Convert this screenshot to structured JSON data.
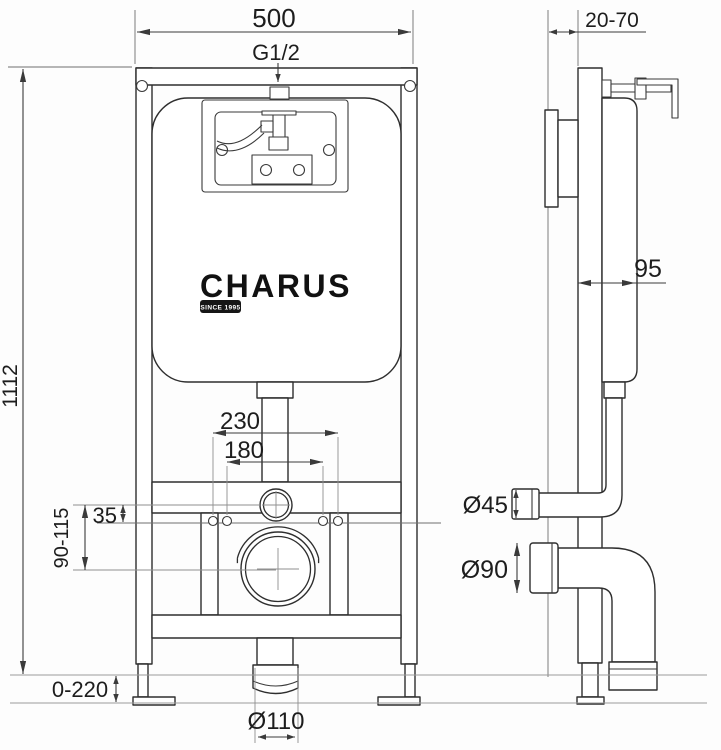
{
  "brand": {
    "name": "CHARUS",
    "tagline": "SINCE 1995"
  },
  "dimensions": {
    "frame_width": "500",
    "inlet_thread": "G1/2",
    "wall_distance": "20-70",
    "frame_height": "1112",
    "frame_depth": "95",
    "fixing_outer": "230",
    "fixing_inner": "180",
    "center_offset": "35",
    "flush_pipe_height": "90-115",
    "leg_adjustment": "0-220",
    "outlet_diameter": "Ø110",
    "flush_pipe_diameter": "Ø45",
    "drain_pipe_diameter": "Ø90"
  }
}
